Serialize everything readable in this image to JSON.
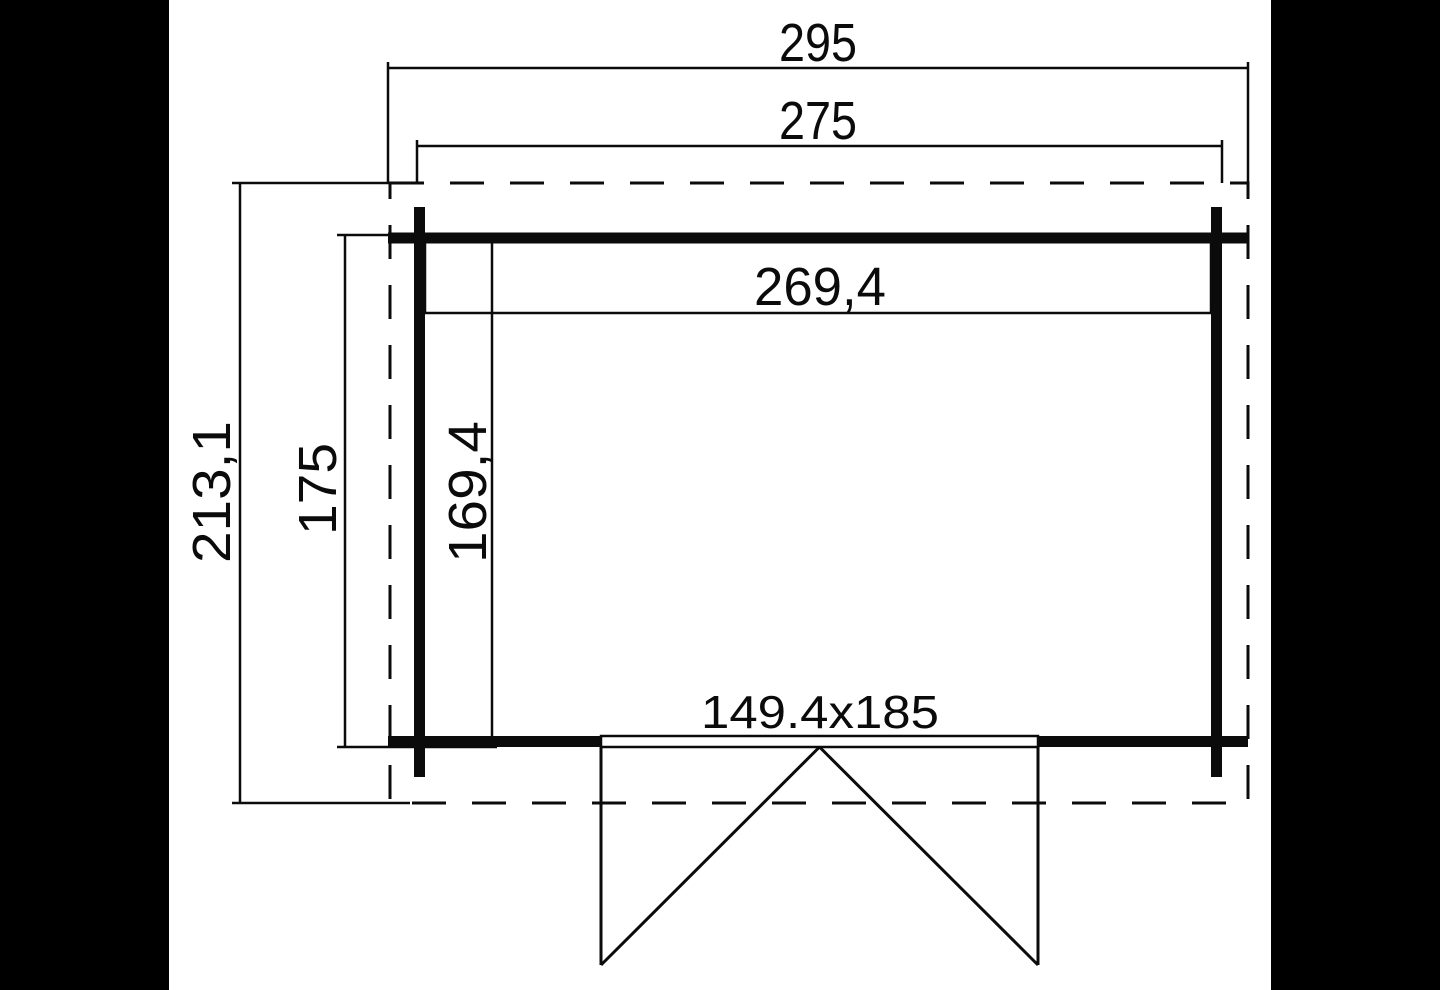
{
  "drawing": {
    "type": "floor-plan",
    "description": "Log cabin / garden shed floor plan with outer roof outline (dashed), log walls (thick lines), interior dimensions and a double door at the bottom",
    "colors": {
      "background": "#ffffff",
      "lines": "#0b0b0b",
      "letterbox_bars": "#000000"
    },
    "dimensions": {
      "overall_width": "295",
      "wall_outer_width": "275",
      "interior_width": "269,4",
      "overall_depth": "213,1",
      "wall_outer_depth": "175",
      "interior_depth": "169,4",
      "door_size": "149.4x185"
    }
  }
}
